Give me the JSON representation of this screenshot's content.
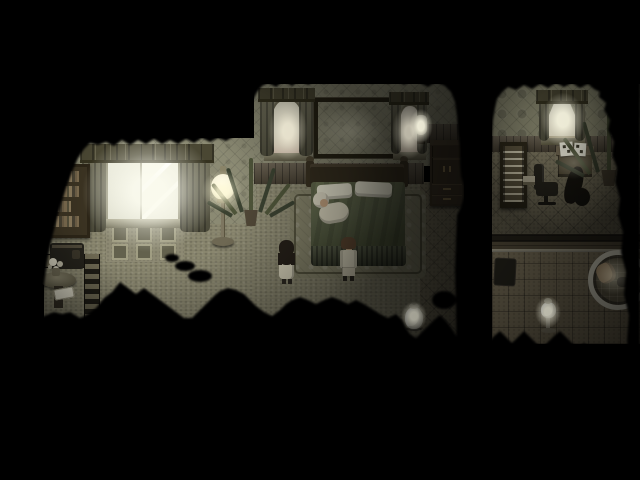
{
  "scene": {
    "description": "Top-down pixel-art horror RPG interior at night: a dark wallpapered bedroom where an elderly figure lies in a double bed, two children stand at the foot of the bed facing it, a glowing window and floor lamp light the left side, a landscape painting hangs between two curtained windows, an adjoining study holds a desk with papers, office chair, tall shelf and large plant, and a small tiled bathroom below it holds a round tub and a pedestal lamp; thick black fog swallows the screen edges",
    "canvas": {
      "width": 640,
      "height": 480,
      "background": "#000000"
    },
    "visible_text": []
  },
  "palette": {
    "background": "#000000",
    "wallpaper": "#8b8a73",
    "wallpaper_study": "#85846c",
    "wainscot": "#5a5140",
    "plank_wall": "#4c4434",
    "floor": "#8a876f",
    "floor_diamond": "#7b755e",
    "floor_tile": "#746b55",
    "rug": "#838168",
    "rug_window": "#8d8a73",
    "window_frame": "#918f77",
    "window_light": "#f3f3e6",
    "curtain": "#6b6952",
    "valance": "#4a4733",
    "bed_wood": "#352e1f",
    "bed_blanket": "#5d644a",
    "bed_pillow": "#e8e5d0",
    "bed_skirt": "#4e543e",
    "lamp_glow": "#fdfbe9",
    "jar": "#e8e6d4",
    "paper": "#eceada",
    "chair": "#26241c",
    "desk": "#544c38",
    "wardrobe": "#3e3526",
    "bookshelf": "#3b3322",
    "shelf_tall": "#2c2719",
    "plant": "#4e5439",
    "tub_rim": "#cfccba",
    "towel": "#b29974",
    "trim_light": "#b8b4a0"
  },
  "rooms": [
    {
      "id": "bedroom",
      "desc": "large bedroom with double bed, big lit window, bookshelf, floor lamp, wardrobe, painting"
    },
    {
      "id": "study",
      "desc": "small study with arched lit window, tall shelf, desk with papers, office chair, large potted plant"
    },
    {
      "id": "bathroom",
      "desc": "tiled bathroom with round tub, towel, pedestal lamp and dark mat"
    }
  ],
  "characters": [
    {
      "id": "girl",
      "desc": "small girl with long dark hair in pale dress, standing, back to camera, facing bed",
      "hair_color": "#262019",
      "outfit_color": "#d6d1b9"
    },
    {
      "id": "boy",
      "desc": "small boy with short brown hair in pale outfit, standing, back to camera, facing bed",
      "hair_color": "#5f4832",
      "outfit_color": "#dbd6be"
    },
    {
      "id": "elder",
      "desc": "white-haired elderly figure lying on left side of the bed under the blanket",
      "hair_color": "#ded9c4",
      "outfit_color": "#d8d3bc"
    }
  ],
  "lights": [
    {
      "id": "big-window",
      "color": "#f3f3e6"
    },
    {
      "id": "floor-lamp",
      "color": "#fdfbe9"
    },
    {
      "id": "back-window-left",
      "color": "#ece5cf"
    },
    {
      "id": "back-window-right",
      "color": "#efe9d6"
    },
    {
      "id": "wall-sconce",
      "color": "#f8f6e2"
    },
    {
      "id": "study-window",
      "color": "#f7f5e2"
    },
    {
      "id": "floor-jar",
      "color": "#e8e6d4"
    },
    {
      "id": "bath-pedestal-lamp",
      "color": "#e8e6d4"
    }
  ],
  "furniture": {
    "bedroom": [
      "bookshelf with books",
      "dark side table",
      "round table with flowers and open book",
      "checkered carpet border",
      "window rug with square motifs",
      "big double window with curtains and valance",
      "floor lamp with glowing globe",
      "tall potted plant",
      "curtained window left of painting",
      "landscape painting",
      "curtained window right of painting",
      "wall sconce",
      "double bed with two pillows and green blanket",
      "bed rug",
      "wardrobe with drawers",
      "white lidded floor jar"
    ],
    "study": [
      "tall ladder shelf",
      "desk with two white papers",
      "dark office chair",
      "small light box",
      "dark instrument case",
      "large spiky potted plant"
    ],
    "bathroom": [
      "dark bath mat",
      "pedestal lamp with white jar shade",
      "round tub with towel"
    ]
  }
}
